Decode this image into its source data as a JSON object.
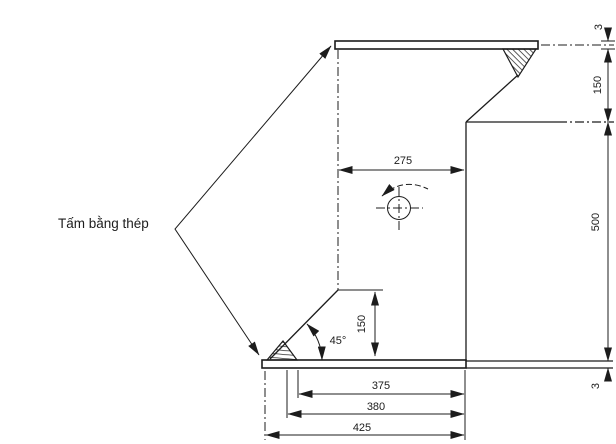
{
  "drawing": {
    "callout": {
      "plate_label": "Tấm bằng thép"
    },
    "dimensions": {
      "top_face_width": "275",
      "chamfer_height": "150",
      "chamfer_angle": "45°",
      "bottom_width_inner": "375",
      "bottom_width_mid": "380",
      "bottom_width_outer": "425",
      "top_plate_thickness": "3",
      "flange_offset": "150",
      "web_height": "500",
      "bottom_plate_thickness": "3"
    },
    "colors": {
      "ink": "#1c1c1c",
      "paper": "#ffffff"
    }
  }
}
